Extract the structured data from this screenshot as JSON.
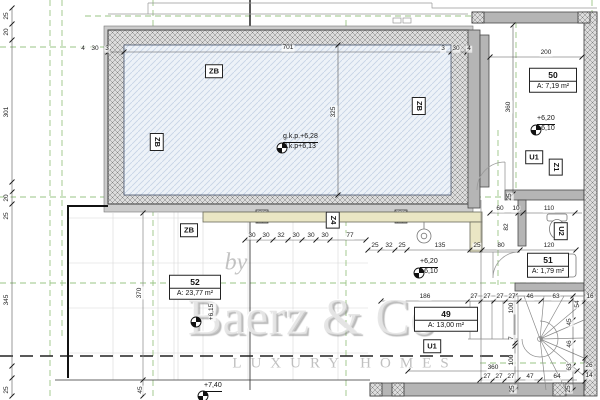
{
  "watermark": {
    "prefix": "by",
    "brand": "Baerz & Co",
    "tagline": "LUXURY HOMES"
  },
  "room_labels": [
    {
      "number": "50",
      "area": "A: 7,19 m²",
      "x": 553,
      "y": 80,
      "w": 46
    },
    {
      "number": "51",
      "area": "A: 1,79 m²",
      "x": 548,
      "y": 265,
      "w": 40
    },
    {
      "number": "49",
      "area": "A: 13,00 m²",
      "x": 446,
      "y": 319,
      "w": 62
    },
    {
      "number": "52",
      "area": "A: 23,77 m²",
      "x": 195,
      "y": 287,
      "w": 50
    }
  ],
  "zone_tags": [
    {
      "t": "ZB",
      "x": 214,
      "y": 71,
      "v": 0
    },
    {
      "t": "ZB",
      "x": 157,
      "y": 142,
      "v": 1
    },
    {
      "t": "ZB",
      "x": 419,
      "y": 106,
      "v": 1
    },
    {
      "t": "ZB",
      "x": 189,
      "y": 230,
      "v": 0
    },
    {
      "t": "Z4",
      "x": 333,
      "y": 220,
      "v": 1
    },
    {
      "t": "Z1",
      "x": 556,
      "y": 167,
      "v": 1
    },
    {
      "t": "U1",
      "x": 534,
      "y": 157,
      "v": 0
    },
    {
      "t": "U2",
      "x": 561,
      "y": 231,
      "v": 1
    },
    {
      "t": "U1",
      "x": 432,
      "y": 346,
      "v": 0
    }
  ],
  "level_markers": [
    {
      "lines": [
        "+6,20",
        "+6,10"
      ],
      "x": 530,
      "y": 124,
      "rot": 0
    },
    {
      "lines": [
        "+6,20",
        "+6,10"
      ],
      "x": 413,
      "y": 267,
      "rot": 0
    },
    {
      "lines": [
        "g.k.p.+6,28",
        "d.k.p+6,13"
      ],
      "x": 276,
      "y": 142,
      "rot": 0
    },
    {
      "lines": [
        "+7,40"
      ],
      "x": 197,
      "y": 390,
      "rot": 0
    },
    {
      "lines": [
        "+6,15"
      ],
      "x": 190,
      "y": 316,
      "rot": 1
    }
  ],
  "dims": [
    {
      "t": "25",
      "x": 7,
      "y": 16,
      "r": 1
    },
    {
      "t": "20",
      "x": 7,
      "y": 32,
      "r": 1
    },
    {
      "t": "301",
      "x": 7,
      "y": 112,
      "r": 1
    },
    {
      "t": "20",
      "x": 7,
      "y": 198,
      "r": 1
    },
    {
      "t": "25",
      "x": 7,
      "y": 216,
      "r": 1
    },
    {
      "t": "345",
      "x": 7,
      "y": 300,
      "r": 1
    },
    {
      "t": "25",
      "x": 7,
      "y": 390,
      "r": 1
    },
    {
      "t": "4",
      "x": 83,
      "y": 49
    },
    {
      "t": "30",
      "x": 95,
      "y": 49
    },
    {
      "t": "3",
      "x": 107,
      "y": 49
    },
    {
      "t": "701",
      "x": 288,
      "y": 48
    },
    {
      "t": "3",
      "x": 443,
      "y": 49
    },
    {
      "t": "30",
      "x": 456,
      "y": 49
    },
    {
      "t": "4",
      "x": 469,
      "y": 49
    },
    {
      "t": "325",
      "x": 334,
      "y": 112,
      "r": 1
    },
    {
      "t": "200",
      "x": 546,
      "y": 53
    },
    {
      "t": "360",
      "x": 509,
      "y": 107,
      "r": 1
    },
    {
      "t": "30",
      "x": 252,
      "y": 236
    },
    {
      "t": "30",
      "x": 266,
      "y": 236
    },
    {
      "t": "32",
      "x": 281,
      "y": 236
    },
    {
      "t": "30",
      "x": 296,
      "y": 236
    },
    {
      "t": "30",
      "x": 311,
      "y": 236
    },
    {
      "t": "30",
      "x": 325,
      "y": 236
    },
    {
      "t": "77",
      "x": 350,
      "y": 236
    },
    {
      "t": "25",
      "x": 375,
      "y": 246
    },
    {
      "t": "32",
      "x": 389,
      "y": 246
    },
    {
      "t": "25",
      "x": 402,
      "y": 246
    },
    {
      "t": "135",
      "x": 440,
      "y": 246
    },
    {
      "t": "25",
      "x": 477,
      "y": 246
    },
    {
      "t": "80",
      "x": 501,
      "y": 246
    },
    {
      "t": "120",
      "x": 549,
      "y": 246
    },
    {
      "t": "60",
      "x": 500,
      "y": 209
    },
    {
      "t": "10",
      "x": 516,
      "y": 209
    },
    {
      "t": "110",
      "x": 549,
      "y": 209
    },
    {
      "t": "25",
      "x": 510,
      "y": 197,
      "r": 1
    },
    {
      "t": "82",
      "x": 507,
      "y": 227,
      "r": 1
    },
    {
      "t": "186",
      "x": 425,
      "y": 297
    },
    {
      "t": "27",
      "x": 474,
      "y": 297
    },
    {
      "t": "27",
      "x": 487,
      "y": 297
    },
    {
      "t": "27",
      "x": 500,
      "y": 297
    },
    {
      "t": "27",
      "x": 512,
      "y": 297
    },
    {
      "t": "46",
      "x": 530,
      "y": 297
    },
    {
      "t": "63",
      "x": 556,
      "y": 297
    },
    {
      "t": "16",
      "x": 590,
      "y": 297
    },
    {
      "t": "54",
      "x": 578,
      "y": 304,
      "r": 1
    },
    {
      "t": "45",
      "x": 570,
      "y": 322,
      "r": 1
    },
    {
      "t": "46",
      "x": 570,
      "y": 344,
      "r": 1
    },
    {
      "t": "63",
      "x": 570,
      "y": 367,
      "r": 1
    },
    {
      "t": "26",
      "x": 589,
      "y": 366
    },
    {
      "t": "14",
      "x": 589,
      "y": 376
    },
    {
      "t": "100",
      "x": 512,
      "y": 308,
      "r": 1
    },
    {
      "t": "7",
      "x": 512,
      "y": 338,
      "r": 1
    },
    {
      "t": "100",
      "x": 512,
      "y": 360,
      "r": 1
    },
    {
      "t": "360",
      "x": 493,
      "y": 368
    },
    {
      "t": "27",
      "x": 487,
      "y": 377
    },
    {
      "t": "27",
      "x": 499,
      "y": 377
    },
    {
      "t": "27",
      "x": 511,
      "y": 377
    },
    {
      "t": "47",
      "x": 530,
      "y": 377
    },
    {
      "t": "64",
      "x": 557,
      "y": 377
    },
    {
      "t": "25",
      "x": 513,
      "y": 389,
      "r": 1
    },
    {
      "t": "25",
      "x": 569,
      "y": 389,
      "r": 1
    },
    {
      "t": "45",
      "x": 141,
      "y": 390,
      "r": 1
    },
    {
      "t": "370",
      "x": 140,
      "y": 293,
      "r": 1
    }
  ]
}
